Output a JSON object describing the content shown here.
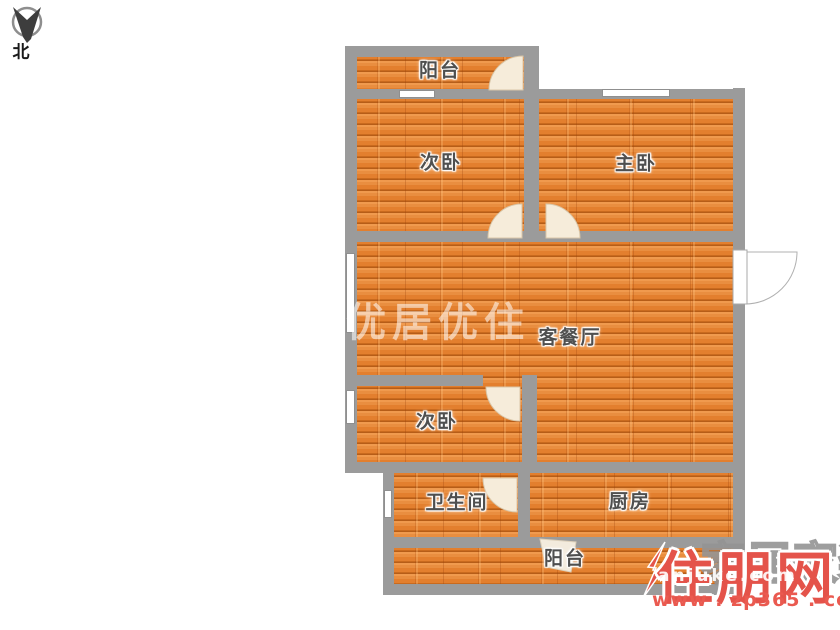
{
  "compass": {
    "label": "北"
  },
  "rooms": {
    "balcony_top": {
      "label": "阳台"
    },
    "bedroom_top_left": {
      "label": "次卧"
    },
    "master_bedroom": {
      "label": "主卧"
    },
    "living_dining": {
      "label": "客餐厅"
    },
    "bedroom_mid_left": {
      "label": "次卧"
    },
    "bathroom": {
      "label": "卫生间"
    },
    "kitchen": {
      "label": "厨房"
    },
    "balcony_bottom": {
      "label": "阳台"
    }
  },
  "watermarks": {
    "center_text": "优居优住",
    "corner_gray_text": "家居家装",
    "corner_site_name": "住朋网",
    "corner_white_text": "anjuke.com",
    "corner_url": "www . zp365 . com"
  },
  "colors": {
    "floor_main": "#e8873a",
    "floor_seam": "#b65d18",
    "wall": "#9b9b9b",
    "door_fill": "#f6ecda",
    "label_text": "#4f4f4f",
    "watermark_red": "#e4534a",
    "watermark_center": "rgba(255,255,255,0.55)"
  }
}
